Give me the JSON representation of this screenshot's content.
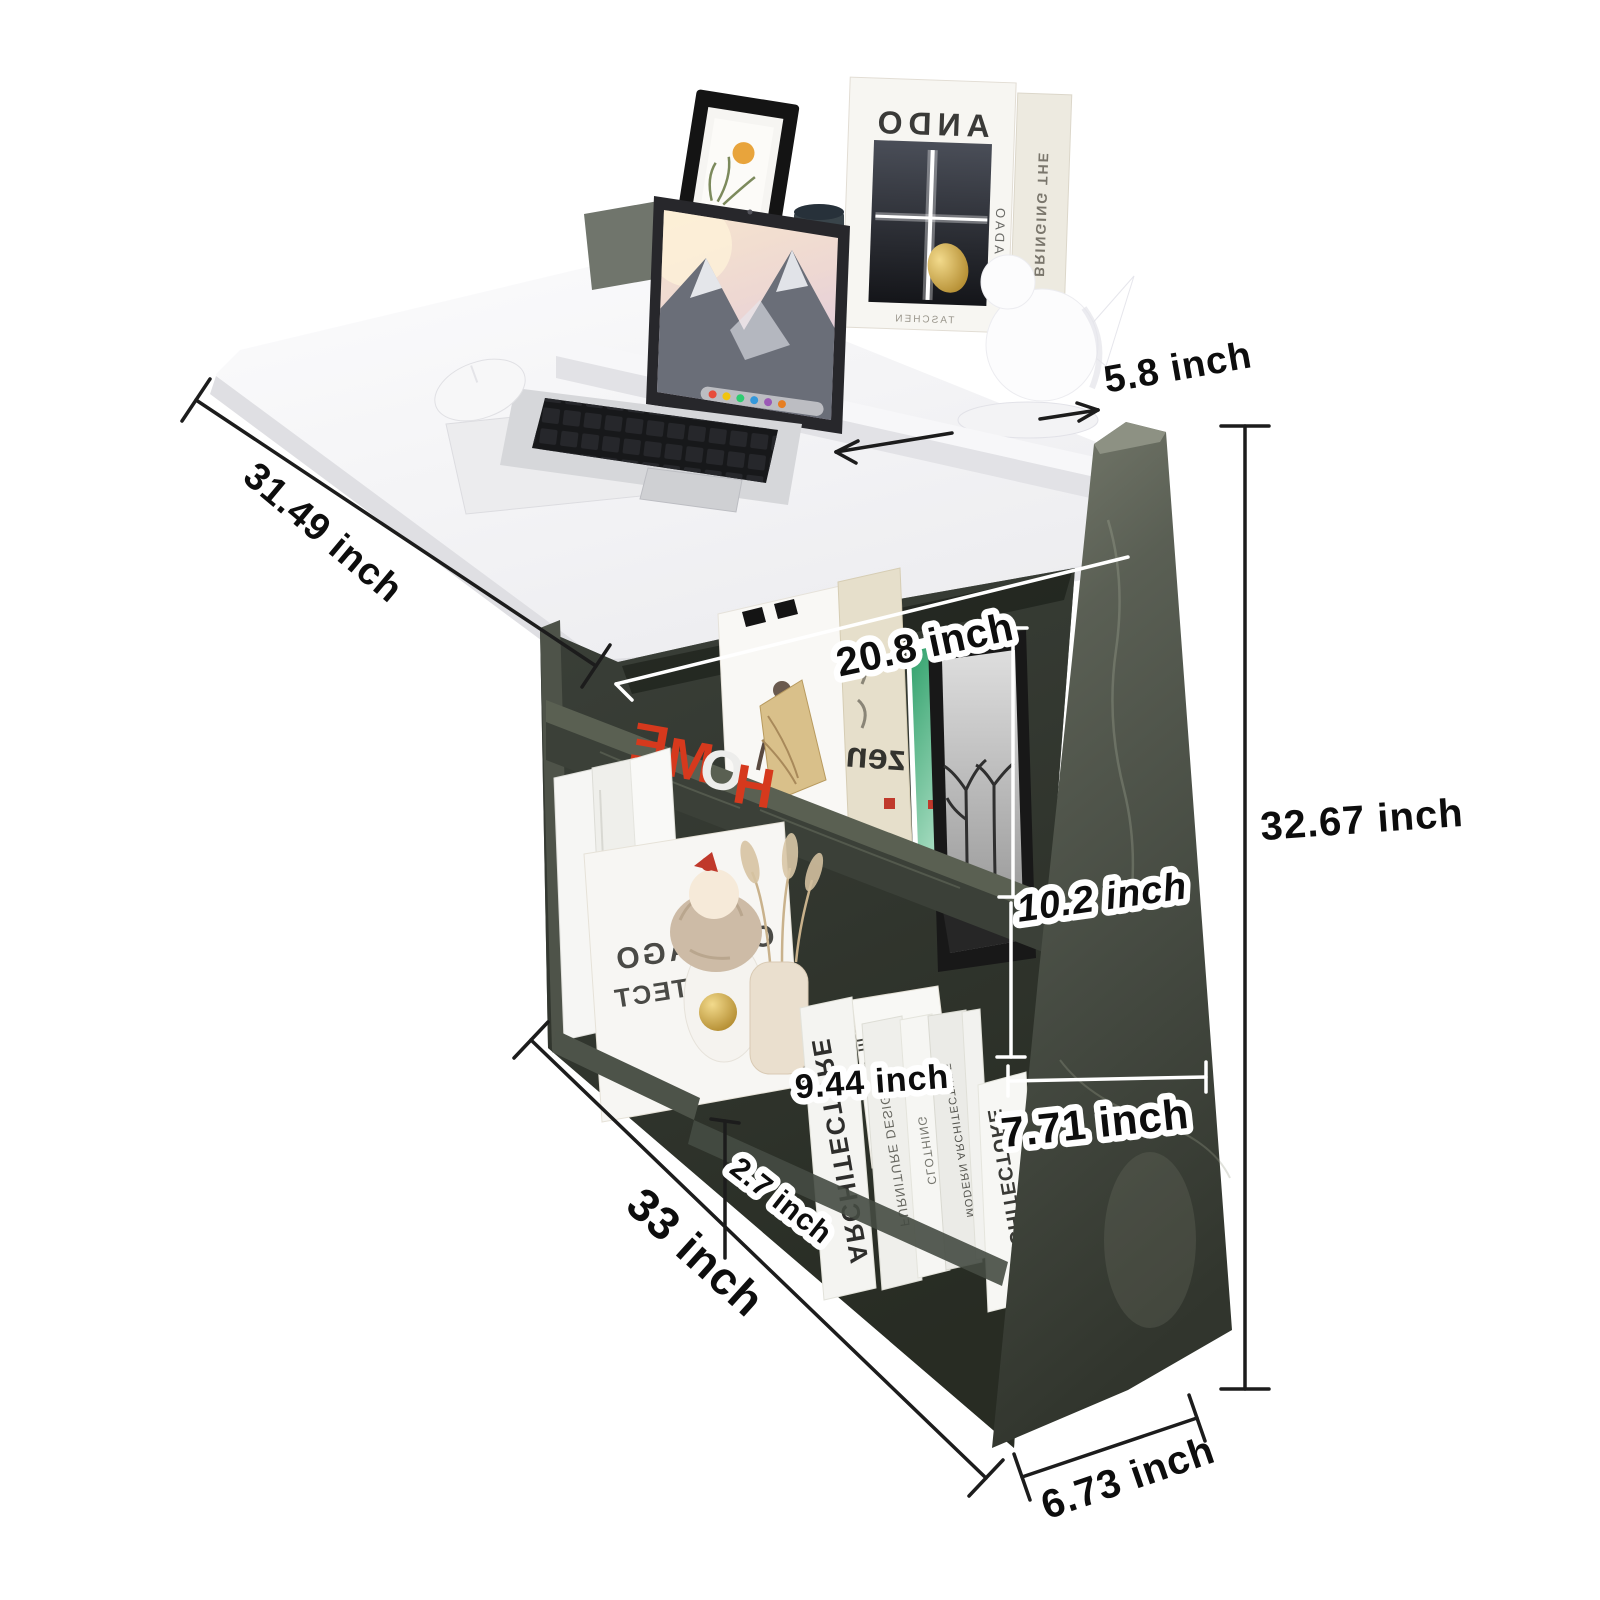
{
  "canvas": {
    "width": 1600,
    "height": 1600,
    "background": "#ffffff"
  },
  "dimensions": {
    "shelf_depth": {
      "label": "5.8 inch",
      "value": "5.8",
      "unit": "inch"
    },
    "desk_length": {
      "label": "31.49 inch",
      "value": "31.49",
      "unit": "inch"
    },
    "inner_width": {
      "label": "20.8 inch",
      "value": "20.8",
      "unit": "inch"
    },
    "overall_height": {
      "label": "32.67 inch",
      "value": "32.67",
      "unit": "inch"
    },
    "upper_compartment_height": {
      "label": "10.2 inch",
      "value": "10.2",
      "unit": "inch"
    },
    "lower_compartment_height": {
      "label": "9.44 inch",
      "value": "9.44",
      "unit": "inch"
    },
    "side_panel_width": {
      "label": "7.71 inch",
      "value": "7.71",
      "unit": "inch"
    },
    "base_edge_height": {
      "label": "2.7 inch",
      "value": "2.7",
      "unit": "inch"
    },
    "overall_length": {
      "label": "33 inch",
      "value": "33",
      "unit": "inch"
    },
    "bottom_depth": {
      "label": "6.73 inch",
      "value": "6.73",
      "unit": "inch"
    }
  },
  "decor": {
    "book_ando": {
      "title": "ANDO",
      "author": "TADAO",
      "spine": "BRINGING THE",
      "publisher": "TASCHEN"
    },
    "home_sign": {
      "letters": [
        "H",
        "O",
        "M",
        "E"
      ]
    },
    "book_zen": {
      "title": "zen"
    },
    "book_chicago": {
      "line1": "CHICAGO",
      "line2": "ARCHITECT"
    },
    "book_architecture_left": {
      "spine": "ARCHITECTURE"
    },
    "book_archite_design": {
      "line1": "ARCHITE",
      "line2": "DESIGN"
    },
    "book_furniture": {
      "spine": "FURNITURE DESIGN"
    },
    "book_clothing": {
      "spine": "CLOTHING"
    },
    "book_modern": {
      "spine": "MODERN ARCHITECTURE"
    },
    "book_architecture_right": {
      "spine": "ARCHITECTURE"
    }
  },
  "colors": {
    "label_text": "#0d0d0d",
    "label_outline": "#ffffff",
    "dim_line_dark": "#1c1c1c",
    "dim_line_light": "#ffffff",
    "desk_white": "#f4f4f6",
    "cabinet_dark": "#353a33",
    "panel_gray": "#565b50",
    "accent_red": "#d6391d",
    "gold": "#c9a23a"
  }
}
